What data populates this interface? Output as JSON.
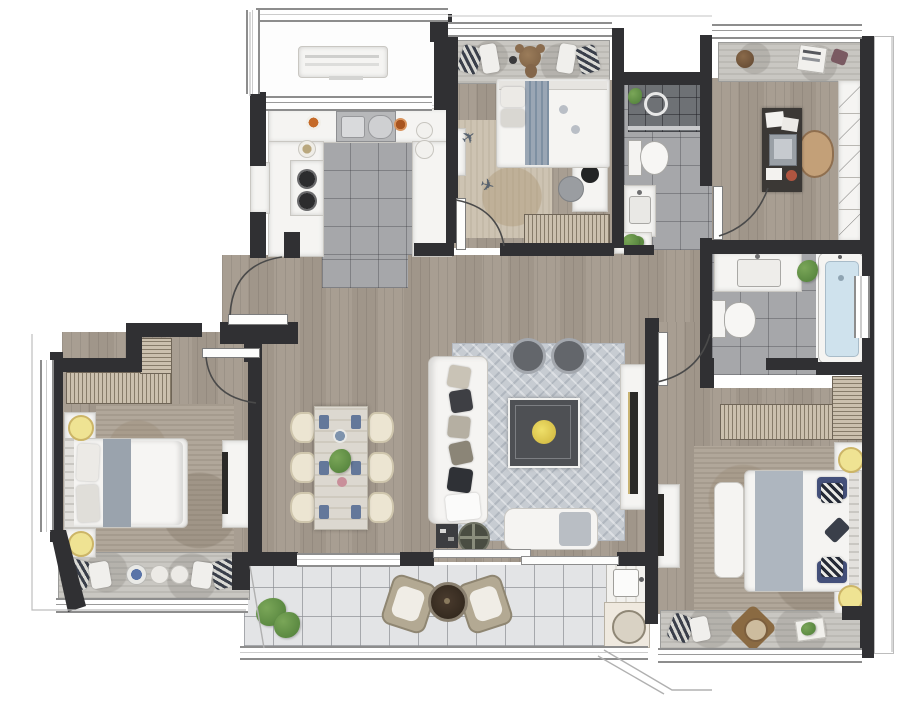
{
  "title": "apartment-floor-plan-render",
  "palette": {
    "wall": "#303033",
    "wood": "#a89e92",
    "tile": "#a6a7aa",
    "tileDark": "#6e7175",
    "balconyTile": "#e3e4e6",
    "white": "#f5f4f2",
    "whiteBorder": "#c9c7c2",
    "rugLiving": "#c7ccd2",
    "rugBeige": "#cdc3b2",
    "rugTaupe": "#b1a79a",
    "bayCushion": "#c9c7c2",
    "accentYellow": "#efe393",
    "accentYellowBorder": "#ccb567",
    "plantGreen": "#4e7d38",
    "plantGreen2": "#7aa658",
    "water": "#cfe2ed",
    "navy": "#44507a",
    "denim": "#9aa6b4",
    "darkFurniture": "#45464a",
    "deskBrown": "#3b3835",
    "tan": "#c3a078",
    "hatchBg": "#cbc0ae",
    "hatchLine": "#877c6a",
    "marble": "#dcd8d0"
  },
  "rooms": [
    {
      "id": "service-balcony",
      "furniture": [
        "ac-unit"
      ]
    },
    {
      "id": "kitchen",
      "furniture": [
        "double-sink",
        "gas-stove",
        "counter",
        "fridge",
        "plates"
      ]
    },
    {
      "id": "kids-bedroom",
      "furniture": [
        "bay-window-seat",
        "teddy-bear",
        "single-bed",
        "rug",
        "toy-airplanes",
        "desk",
        "pouf",
        "wardrobe",
        "wall-shelf"
      ]
    },
    {
      "id": "shared-bathroom",
      "furniture": [
        "shower",
        "toilet",
        "vanity-sink",
        "plant"
      ]
    },
    {
      "id": "study",
      "furniture": [
        "bay-window-seat",
        "desk",
        "laptop",
        "chair",
        "bookshelf",
        "books"
      ]
    },
    {
      "id": "master-bathroom",
      "furniture": [
        "vanity-sink",
        "plant",
        "bathtub",
        "toilet"
      ]
    },
    {
      "id": "hallway",
      "furniture": [
        "console-table",
        "plant"
      ]
    },
    {
      "id": "living-room",
      "furniture": [
        "sofa",
        "throw-pillows",
        "poufs",
        "coffee-table",
        "flowers",
        "tv-console",
        "tv",
        "bench",
        "side-table",
        "round-tray"
      ]
    },
    {
      "id": "dining-area",
      "furniture": [
        "dining-table",
        "chairs-x6",
        "place-settings",
        "centerpiece"
      ]
    },
    {
      "id": "bedroom-left",
      "furniture": [
        "wardrobe",
        "double-bed",
        "nightstands",
        "lamps",
        "rug",
        "tv-console",
        "bay-window-seat"
      ]
    },
    {
      "id": "bedroom-right",
      "furniture": [
        "wardrobes",
        "double-bed",
        "bench",
        "nightstands",
        "lamps",
        "rug",
        "tv-console",
        "bay-window-seat",
        "round-tray"
      ]
    },
    {
      "id": "balcony",
      "furniture": [
        "plant",
        "lounge-chair",
        "round-table",
        "lounge-chair",
        "laundry-sink",
        "washing-machine"
      ]
    },
    {
      "id": "entry",
      "furniture": [
        "entry-door"
      ]
    }
  ]
}
